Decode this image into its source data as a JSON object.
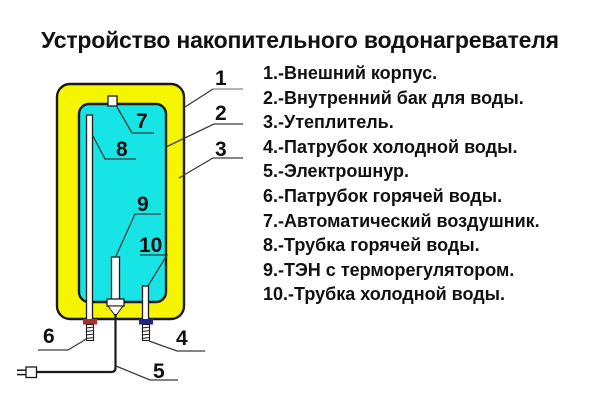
{
  "title": "Устройство накопительного водонагревателя",
  "legend": {
    "items": [
      "1.-Внешний корпус.",
      "2.-Внутренний бак для воды.",
      "3.-Утеплитель.",
      "4.-Патрубок холодной воды.",
      "5.-Электрошнур.",
      "6.-Патрубок горячей воды.",
      "7.-Автоматический воздушник.",
      "8.-Трубка горячей воды.",
      "9.-ТЭН с терморегулятором.",
      "10.-Трубка холодной воды."
    ]
  },
  "diagram": {
    "callouts": [
      "1",
      "2",
      "3",
      "4",
      "5",
      "6",
      "7",
      "8",
      "9",
      "10"
    ]
  },
  "colors": {
    "casing-yellow": "#f5f500",
    "tank-cyan": "#17e5e5",
    "hot-band-red": "#b02b2b",
    "cold-band-blue": "#23238f",
    "line": "#1a1a1a"
  }
}
